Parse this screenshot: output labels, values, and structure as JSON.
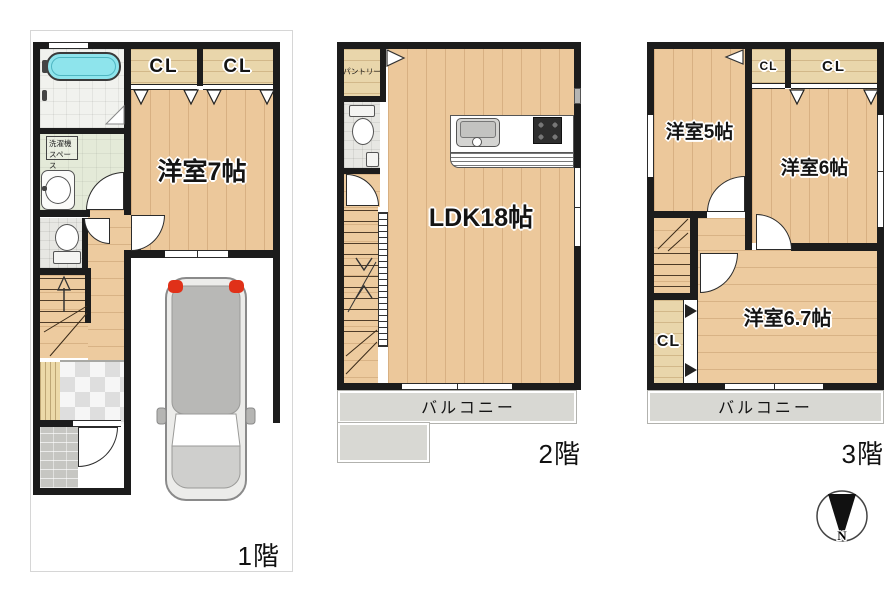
{
  "floor1": {
    "label": "1階",
    "closet_left": "CL",
    "closet_right": "CL",
    "bedroom": "洋室7帖",
    "laundry_line1": "洗濯機",
    "laundry_line2": "スペース"
  },
  "floor2": {
    "label": "2階",
    "pantry": "パントリー",
    "living": "LDK18帖",
    "balcony": "バルコニー"
  },
  "floor3": {
    "label": "3階",
    "bedroom_5": "洋室5帖",
    "bedroom_6": "洋室6帖",
    "bedroom_6_7": "洋室6.7帖",
    "closet_small": "CL",
    "closet_wide": "CL",
    "closet_side": "CL",
    "balcony": "バルコニー"
  },
  "compass": {
    "north": "N"
  }
}
